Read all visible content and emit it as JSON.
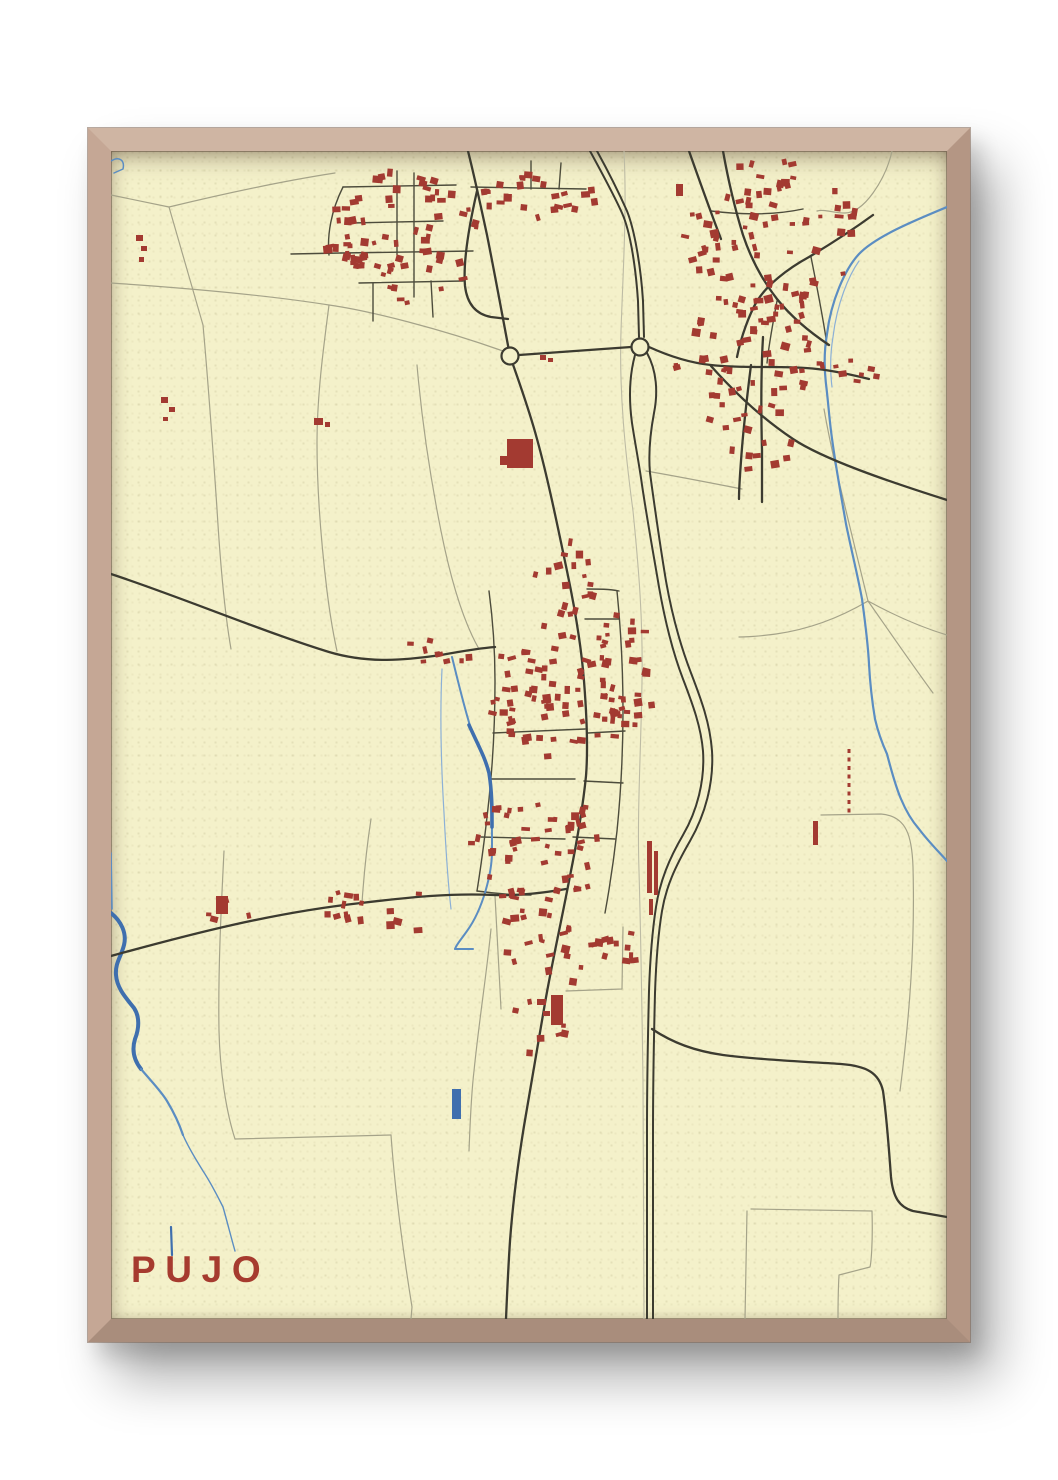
{
  "poster": {
    "title": "PUJO",
    "colors": {
      "wall": "#ffffff",
      "frame": "#c0a28e",
      "paper": "#f4f1ca",
      "building": "#a33a31",
      "road_major": "#3c3b30",
      "street": "#4d4c3c",
      "road_minor": "#a5a389",
      "track": "#bdbba4",
      "water": "#5b8dc2",
      "water_deep": "#3f6fae",
      "water_pale": "#8cb0d6",
      "dashed_red": "#a33a31",
      "title": "#a63b2f"
    }
  },
  "map": {
    "viewbox": "0 0 836 1168",
    "seed": 7,
    "roads_minor": [
      "M0,44 L58,56 L92,174",
      "M58,56 C116,42 172,30 224,22",
      "M92,174 C98,240 102,300 106,358 C109,408 113,458 120,498",
      "M218,154 C212,200 206,246 206,292 C206,338 210,390 216,440 C219,464 222,482 226,500",
      "M392,200 C330,178 260,160 218,154 C180,148 120,140 0,132",
      "M306,214 C310,260 318,320 330,380 C340,430 352,470 368,498",
      "M455,840 L511,838 L512,776",
      "M113,700 C110,760 107,820 108,880 C109,920 115,960 124,988",
      "M124,988 L280,984",
      "M280,984 C284,1040 292,1100 301,1156 L300,1168",
      "M713,258 C722,310 740,380 757,450",
      "M757,450 C790,468 816,478 836,484",
      "M757,450 C778,480 800,512 822,542",
      "M757,450 C730,466 700,478 665,483 C650,485 638,486 628,486",
      "M710,664 L770,663 C796,665 801,686 802,716 C804,792 799,862 789,940",
      "M640,1058 L761,1060 C762,1092 760,1112 759,1116 L728,1124 C727,1142 727,1156 727,1168",
      "M636,1060 L634,1168",
      "M781,0 C778,14 772,28 762,42 C752,56 742,62 734,62 C722,62 714,58 706,60",
      "M535,320 C570,326 600,332 631,338",
      "M380,778 C376,820 368,870 363,920 C360,945 359,975 358,1000",
      "M251,752 C253,722 256,694 260,668",
      "M384,745 C386,780 388,820 390,858"
    ],
    "streets": [
      "M286,20 L286,104",
      "M303,22 L303,146",
      "M232,36 L345,34",
      "M360,36 L475,38",
      "M240,72 L332,70",
      "M230,102 L362,100",
      "M248,132 L352,130",
      "M180,103 L230,102",
      "M232,36 C220,60 216,84 218,104",
      "M262,132 L262,170",
      "M320,130 L322,166",
      "M420,38 L420,10",
      "M448,38 L450,12",
      "M382,582 L474,578",
      "M378,628 L464,628",
      "M370,686 L454,688",
      "M474,468 L508,468",
      "M477,582 L514,580",
      "M473,630 L512,632",
      "M462,686 L504,688",
      "M476,438 C488,438 498,438 508,440",
      "M366,740 C380,742 400,744 420,744",
      "M600,60 C632,64 664,64 692,58",
      "M666,150 C662,172 658,192 656,212",
      "M700,106 C706,136 712,166 716,194",
      "M378,440 C382,470 384,500 384,530 C384,570 382,610 378,648 C374,686 370,715 366,740",
      "M506,440 C510,480 512,520 512,560 C512,600 510,640 506,680 C502,716 498,740 494,762"
    ],
    "tracks": [
      "M513,0 C516,60 512,120 510,180 C508,240 514,300 522,360 C528,420 532,470 531,530 C530,600 526,660 528,720 C530,790 531,860 532,930 L533,1168"
    ],
    "roads_major": [
      "M357,0 C364,28 370,56 376,84 C384,124 392,168 399,205",
      "M399,205 C407,228 418,258 426,288 C436,324 446,372 456,420 C464,458 470,492 473,530 C476,568 477,600 475,625 C472,655 466,690 459,725 C450,772 441,812 434,852 C427,892 420,932 413,975 C407,1012 402,1050 399,1090 C397,1120 396,1145 395,1168",
      "M366,40 C358,75 352,112 354,135 C356,152 364,163 380,166 L397,168",
      "M408,204 L520,196",
      "M538,196 C560,206 580,212 600,214 C636,218 672,214 706,218 C724,220 742,224 758,228",
      "M600,215 C624,242 652,268 682,288 C712,308 776,330 836,349",
      "M652,186 C650,220 650,260 651,300 L651,351",
      "M612,0 C617,28 624,58 632,84 C640,108 652,130 666,148 C682,168 700,182 718,194",
      "M578,0 C590,34 600,62 610,88",
      "M762,64 C740,80 718,94 698,106 C676,118 656,134 646,150 C638,164 630,186 626,206",
      "M640,214 C636,246 632,280 630,310 C629,324 628,336 628,348",
      "M0,423 C70,446 150,480 218,501 C258,513 295,509 330,504 C352,500 370,497 384,496",
      "M0,805 C80,783 160,762 250,752 C300,746 340,742 383,744 C408,745 432,742 455,738",
      "M541,878 C562,892 584,900 612,904 C650,909 700,911 730,913 C756,915 768,922 772,940 C776,968 778,1000 780,1026 C782,1046 788,1056 802,1060 L836,1066"
    ],
    "highway": [
      "M479,0 C491,22 503,44 511,62 C520,82 525,120 527,150 L528,186",
      "M486,0 C497,20 508,42 516,60 C524,80 530,118 532,150 L533,186",
      "M524,204 C518,226 518,250 521,272 C524,292 528,312 531,334 C537,374 543,406 548,436 C554,470 562,502 572,528 C582,554 590,576 592,600 C594,630 586,660 572,684 C558,708 549,730 545,756 C541,782 539,810 538,840 C537,880 536,930 536,980 L536,1168",
      "M536,202 C546,220 547,242 543,262 C540,278 537,300 539,322 C545,366 550,400 555,430 C561,464 570,496 580,522 C590,548 599,572 601,600 C603,632 594,664 579,690 C564,716 555,736 551,760 C547,784 545,812 544,842 C543,882 542,932 542,982 L542,1168"
    ],
    "water": [
      {
        "d": "M836,56 C802,70 764,86 748,103 C734,118 720,150 716,183 C713,200 713,216 715,233 C717,249 718,264 720,280 C724,312 730,344 735,373 C741,402 747,426 751,448 C754,470 757,492 758,513 C759,532 761,550 764,568 C767,581 771,592 776,603 C780,618 784,634 790,648 C795,660 801,670 808,678 C817,690 827,700 836,710",
        "w": 2.2,
        "c": "water"
      },
      {
        "d": "M748,110 C738,124 726,152 722,186 C719,204 719,220 721,236",
        "w": 1.2,
        "c": "water_pale"
      },
      {
        "d": "M341,506 C346,526 352,552 360,578 C368,596 375,606 378,622 C381,642 381,672 381,700 C381,722 372,758 356,780 C349,790 345,794 344,798",
        "w": 2,
        "c": "water"
      },
      {
        "d": "M344,798 L362,798",
        "w": 2,
        "c": "water"
      },
      {
        "d": "M358,574 C367,594 374,606 378,622 C381,640 381,658 381,676",
        "w": 3.6,
        "c": "water_deep"
      },
      {
        "d": "M331,518 C329,560 330,612 333,662 C335,702 337,732 340,758",
        "w": 1.2,
        "c": "water_pale"
      },
      {
        "d": "M0,762 C10,770 16,782 13,794 C10,806 4,812 5,824 C6,838 16,848 23,857 C29,866 28,878 24,888 C21,898 22,908 30,918",
        "w": 4,
        "c": "water_deep"
      },
      {
        "d": "M30,918 C40,930 50,940 56,950 C62,960 68,972 72,984",
        "w": 2.2,
        "c": "water"
      },
      {
        "d": "M72,984 C78,998 86,1010 92,1020 C100,1032 106,1044 112,1056 C116,1070 120,1086 124,1100",
        "w": 1.4,
        "c": "water"
      },
      {
        "d": "M0,702 L1,758",
        "w": 1.6,
        "c": "water"
      },
      {
        "d": "M0,10 C8,5 14,9 12,18 L3,22",
        "w": 1.5,
        "c": "water"
      },
      {
        "d": "M60,1076 L61,1104",
        "w": 2.2,
        "c": "water_deep"
      }
    ],
    "water_rects": [
      [
        341,
        938,
        9,
        30
      ]
    ],
    "roundabouts": [
      [
        399,
        205,
        8.5
      ],
      [
        529,
        196,
        8.5
      ]
    ],
    "dashed_red": [
      "M738,598 L738,664"
    ],
    "buildings_explicit": [
      [
        396,
        288,
        26,
        29,
        0
      ],
      [
        389,
        305,
        8,
        9,
        0
      ],
      [
        203,
        267,
        9,
        7,
        0
      ],
      [
        214,
        271,
        5,
        5,
        0
      ],
      [
        565,
        33,
        7,
        12,
        0
      ],
      [
        440,
        844,
        12,
        30,
        0
      ],
      [
        426,
        848,
        9,
        6,
        0
      ],
      [
        432,
        860,
        7,
        5,
        0
      ],
      [
        536,
        690,
        5,
        52,
        0
      ],
      [
        543,
        700,
        4,
        44,
        0
      ],
      [
        538,
        748,
        4,
        16,
        0
      ],
      [
        702,
        670,
        5,
        24,
        0
      ],
      [
        429,
        204,
        6,
        5,
        0
      ],
      [
        437,
        207,
        5,
        4,
        0
      ],
      [
        105,
        745,
        12,
        18,
        0
      ],
      [
        25,
        84,
        7,
        6,
        0
      ],
      [
        30,
        95,
        6,
        5,
        0
      ],
      [
        28,
        106,
        5,
        5,
        0
      ],
      [
        50,
        246,
        7,
        6,
        0
      ],
      [
        58,
        256,
        6,
        5,
        0
      ],
      [
        52,
        266,
        5,
        4,
        0
      ]
    ],
    "building_clusters": [
      {
        "cx": 295,
        "cy": 88,
        "rx": 78,
        "ry": 68,
        "n": 66
      },
      {
        "cx": 428,
        "cy": 46,
        "rx": 66,
        "ry": 24,
        "n": 24
      },
      {
        "cx": 238,
        "cy": 102,
        "rx": 26,
        "ry": 16,
        "n": 8
      },
      {
        "cx": 662,
        "cy": 86,
        "rx": 90,
        "ry": 78,
        "n": 78
      },
      {
        "cx": 648,
        "cy": 198,
        "rx": 70,
        "ry": 56,
        "n": 38
      },
      {
        "cx": 650,
        "cy": 288,
        "rx": 48,
        "ry": 40,
        "n": 15
      },
      {
        "cx": 742,
        "cy": 222,
        "rx": 28,
        "ry": 13,
        "n": 7
      },
      {
        "cx": 600,
        "cy": 212,
        "rx": 46,
        "ry": 11,
        "n": 9
      },
      {
        "cx": 458,
        "cy": 426,
        "rx": 34,
        "ry": 40,
        "n": 18
      },
      {
        "cx": 448,
        "cy": 545,
        "rx": 70,
        "ry": 72,
        "n": 80
      },
      {
        "cx": 428,
        "cy": 694,
        "rx": 68,
        "ry": 62,
        "n": 56
      },
      {
        "cx": 512,
        "cy": 528,
        "rx": 32,
        "ry": 66,
        "n": 24
      },
      {
        "cx": 436,
        "cy": 798,
        "rx": 60,
        "ry": 42,
        "n": 24
      },
      {
        "cx": 330,
        "cy": 500,
        "rx": 40,
        "ry": 14,
        "n": 9
      },
      {
        "cx": 268,
        "cy": 760,
        "rx": 72,
        "ry": 24,
        "n": 16
      },
      {
        "cx": 118,
        "cy": 760,
        "rx": 26,
        "ry": 12,
        "n": 4
      },
      {
        "cx": 420,
        "cy": 876,
        "rx": 38,
        "ry": 26,
        "n": 9
      },
      {
        "cx": 608,
        "cy": 252,
        "rx": 15,
        "ry": 26,
        "n": 5
      },
      {
        "cx": 508,
        "cy": 795,
        "rx": 24,
        "ry": 20,
        "n": 8
      }
    ]
  }
}
